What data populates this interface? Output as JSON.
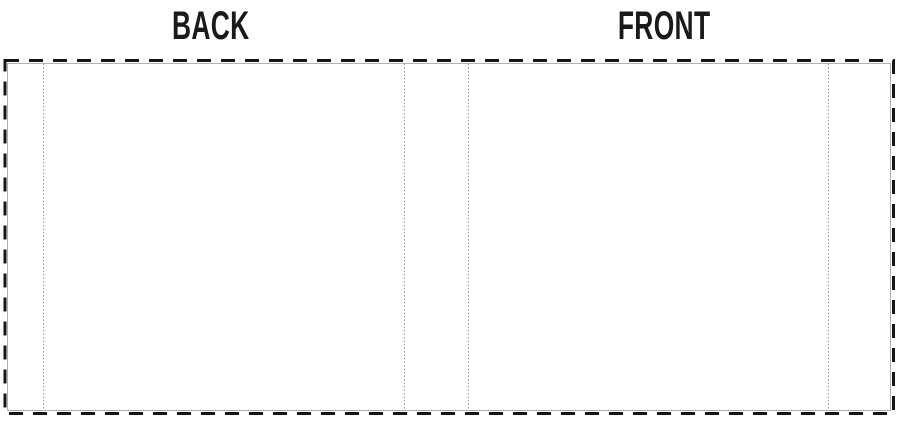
{
  "labels": {
    "back": "BACK",
    "front": "FRONT"
  },
  "colors": {
    "background": "#ffffff",
    "cut_line": "#161616",
    "hairline": "#b0b0b0",
    "fold_line": "#969696",
    "label_text": "#1a1a1a"
  }
}
